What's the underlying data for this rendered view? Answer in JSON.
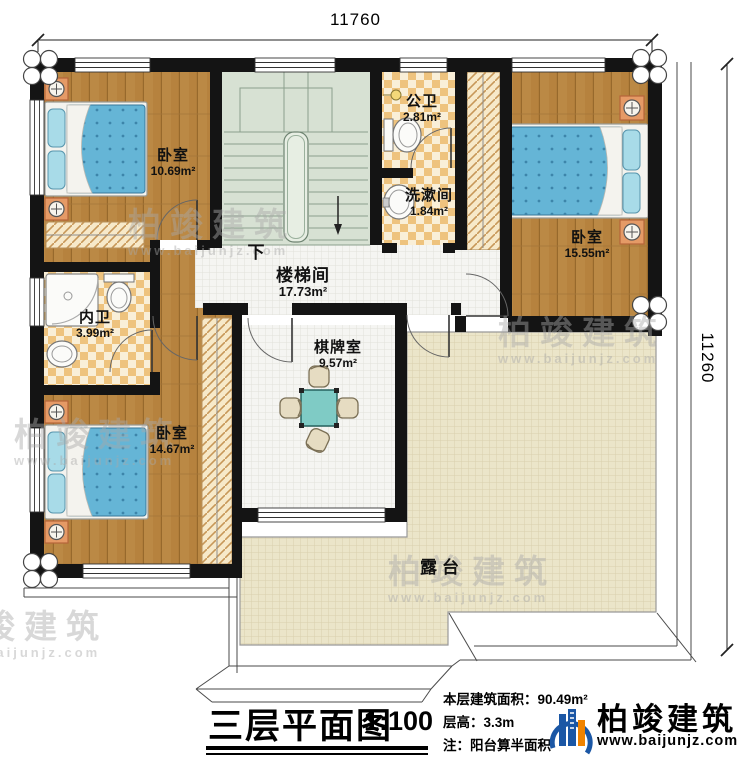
{
  "dimensions": {
    "top": "11760",
    "right": "11260"
  },
  "rooms": {
    "bedroom_top_left": {
      "name": "卧室",
      "area": "10.69m²"
    },
    "public_bath": {
      "name": "公卫",
      "area": "2.81m²"
    },
    "washroom": {
      "name": "洗漱间",
      "area": "1.84m²"
    },
    "bedroom_right": {
      "name": "卧室",
      "area": "15.55m²"
    },
    "stairwell": {
      "name": "楼梯间",
      "area": "17.73m²"
    },
    "inner_bath": {
      "name": "内卫",
      "area": "3.99m²"
    },
    "bedroom_bottom_left": {
      "name": "卧室",
      "area": "14.67m²"
    },
    "game_room": {
      "name": "棋牌室",
      "area": "9.57m²"
    },
    "terrace": {
      "name": "露台"
    }
  },
  "stairs": {
    "down_label": "下"
  },
  "title_block": {
    "title": "三层平面图",
    "scale": "1:100",
    "floor_area": "本层建筑面积：90.49m²",
    "floor_height": "层高：3.3m",
    "note": "注：阳台算半面积"
  },
  "brand": {
    "name": "柏竣建筑",
    "website": "www.baijunjz.com"
  },
  "watermark": {
    "name": "柏竣建筑",
    "website": "www.baijunjz.com"
  },
  "colors": {
    "wall": "#141414",
    "wood": "#b6823e",
    "tile": "#eec37e",
    "stairs": "#d7e1d3",
    "terrace": "#ebe5c9",
    "mattress": "#65b5d6",
    "brand_blue": "#1b57a5",
    "brand_orange": "#f08300"
  }
}
